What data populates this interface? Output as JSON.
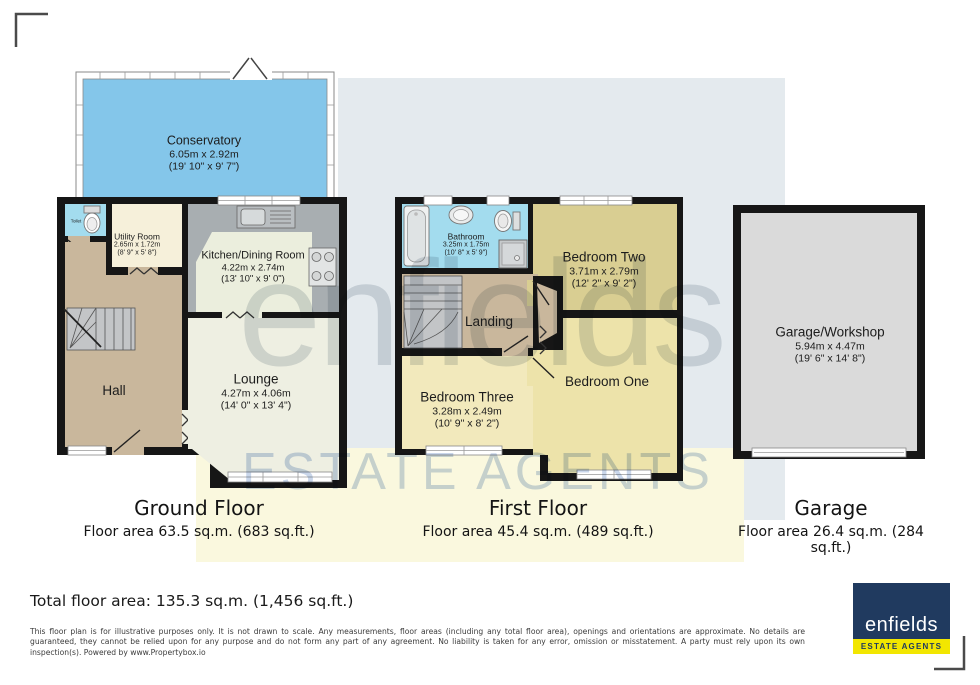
{
  "watermark": {
    "name": "enfields",
    "tagline": "ESTATE AGENTS"
  },
  "plans": {
    "ground": {
      "title": "Ground Floor",
      "area": "Floor area 63.5 sq.m. (683 sq.ft.)",
      "rooms": {
        "conservatory": {
          "name": "Conservatory",
          "metric": "6.05m x 2.92m",
          "imperial": "(19' 10\" x 9' 7\")"
        },
        "toilet": {
          "name": "Toilet"
        },
        "utility": {
          "name": "Utility Room",
          "metric": "2.65m x 1.72m",
          "imperial": "(8' 9\" x 5' 8\")"
        },
        "kitchen": {
          "name": "Kitchen/Dining Room",
          "metric": "4.22m x 2.74m",
          "imperial": "(13' 10\" x 9' 0\")"
        },
        "hall": {
          "name": "Hall"
        },
        "lounge": {
          "name": "Lounge",
          "metric": "4.27m x 4.06m",
          "imperial": "(14' 0\" x 13' 4\")"
        }
      }
    },
    "first": {
      "title": "First Floor",
      "area": "Floor area 45.4 sq.m. (489 sq.ft.)",
      "rooms": {
        "bathroom": {
          "name": "Bathroom",
          "metric": "3.25m x 1.75m",
          "imperial": "(10' 8\" x 5' 9\")"
        },
        "bedroom_two": {
          "name": "Bedroom Two",
          "metric": "3.71m x 2.79m",
          "imperial": "(12' 2\" x 9' 2\")"
        },
        "landing": {
          "name": "Landing"
        },
        "bedroom_three": {
          "name": "Bedroom Three",
          "metric": "3.28m x 2.49m",
          "imperial": "(10' 9\" x 8' 2\")"
        },
        "bedroom_one": {
          "name": "Bedroom One"
        }
      }
    },
    "garage": {
      "title": "Garage",
      "area": "Floor area 26.4 sq.m. (284 sq.ft.)",
      "rooms": {
        "garage_workshop": {
          "name": "Garage/Workshop",
          "metric": "5.94m x 4.47m",
          "imperial": "(19' 6\" x 14' 8\")"
        }
      }
    }
  },
  "footer": {
    "total": "Total floor area: 135.3 sq.m. (1,456 sq.ft.)",
    "disclaimer": "This floor plan is for illustrative purposes only. It is not drawn to scale. Any measurements, floor areas (including any total floor area), openings and orientations are approximate. No details are guaranteed, they cannot be relied upon for any purpose and do not form any part of any agreement. No liability is taken for any error, omission or misstatement. A party must rely upon its own inspection(s). Powered by www.Propertybox.io"
  },
  "logo": {
    "name": "enfields",
    "tagline": "ESTATE AGENTS"
  },
  "colors": {
    "wall": "#161616",
    "conservatory_blue": "#84C6EA",
    "wet_room_blue": "#A3DCEE",
    "utility_cream": "#F6F0DA",
    "kitchen_floor": "#EBEEDD",
    "counter_gray": "#A8AEB1",
    "hall_tan": "#C9B79C",
    "lounge_cream": "#EEEFE2",
    "bedroom_two_khaki": "#D9CE92",
    "bedroom_pale_yellow": "#EDE3AA",
    "bedroom_three_yellow": "#F2E9BC",
    "garage_gray": "#DADADA",
    "band_blue": "#E4EAEE",
    "band_yellow": "#FAF8DE",
    "logo_navy": "#203A5F",
    "logo_yellow": "#F2E600"
  }
}
